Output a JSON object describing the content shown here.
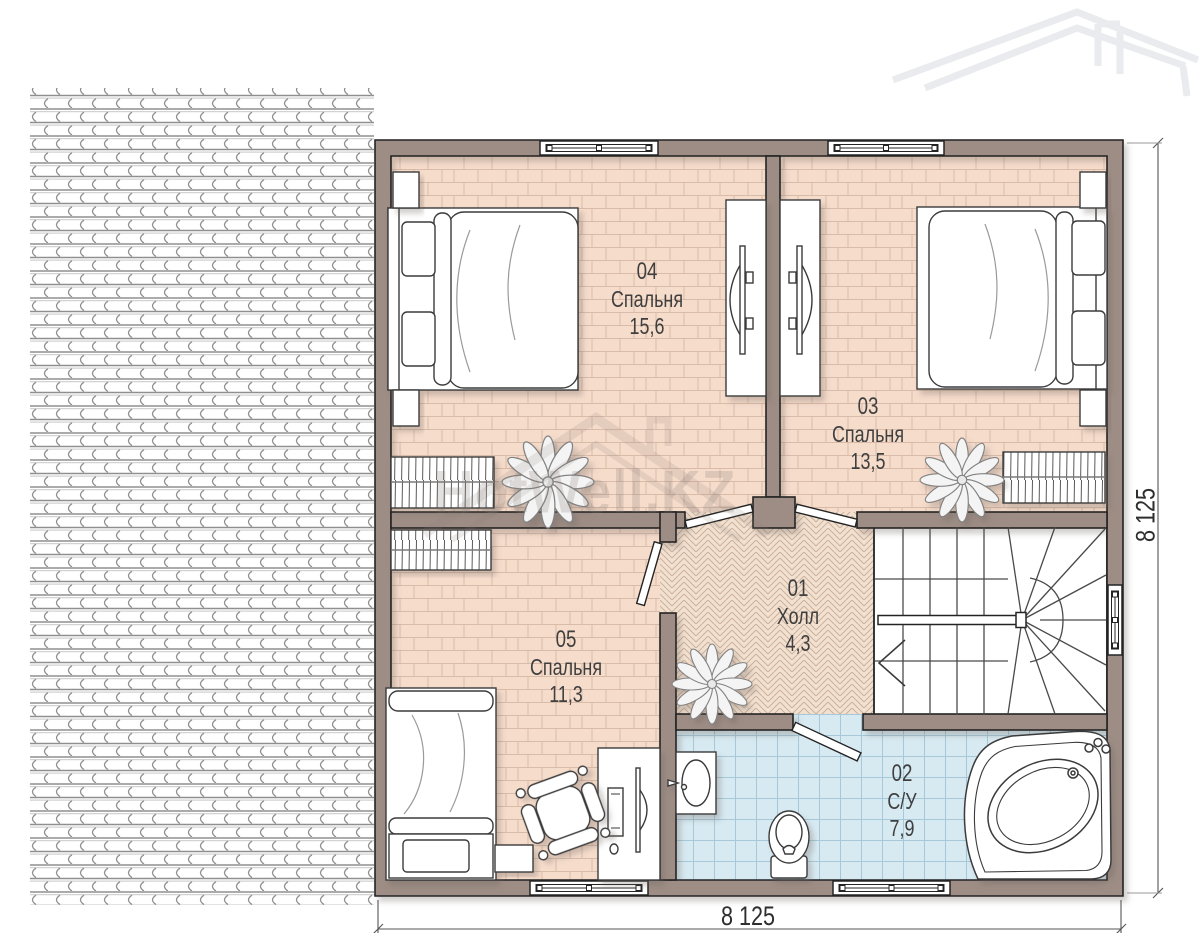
{
  "watermark": {
    "text": "HotWell.KZ"
  },
  "rooms": [
    {
      "number": "04",
      "name": "Спальня",
      "area": "15,6"
    },
    {
      "number": "03",
      "name": "Спальня",
      "area": "13,5"
    },
    {
      "number": "05",
      "name": "Спальня",
      "area": "11,3"
    },
    {
      "number": "01",
      "name": "Холл",
      "area": "4,3"
    },
    {
      "number": "02",
      "name": "С/У",
      "area": "7,9"
    }
  ],
  "dimensions": {
    "bottom": "8 125",
    "right": "8 125"
  },
  "colors": {
    "wall": "#9d8d85",
    "wall_outline": "#242424",
    "bedroom_floor": "#f6dccb",
    "bedroom_floor_line": "#d9bba9",
    "hall_floor": "#f2e1d1",
    "hall_floor_line": "#cdb19b",
    "bath_floor": "#d7eaf2",
    "bath_floor_line": "#a6c8d8",
    "label_text": "#3f3f3f"
  },
  "icons": {
    "roof-tiles": "svg-pattern",
    "house-silhouette-icon": "svg-outline",
    "double-bed-icon": "svg-shape",
    "single-bed-icon": "svg-shape",
    "tv-unit-icon": "svg-shape",
    "radiator-icon": "svg-hatch",
    "plant-icon": "svg-flower",
    "stairs-icon": "svg-lines",
    "sink-icon": "svg-shape",
    "toilet-icon": "svg-shape",
    "bathtub-icon": "svg-shape",
    "desk-icon": "svg-shape",
    "desk-chair-icon": "svg-shape",
    "window-icon": "svg-shape",
    "door-icon": "svg-shape"
  }
}
